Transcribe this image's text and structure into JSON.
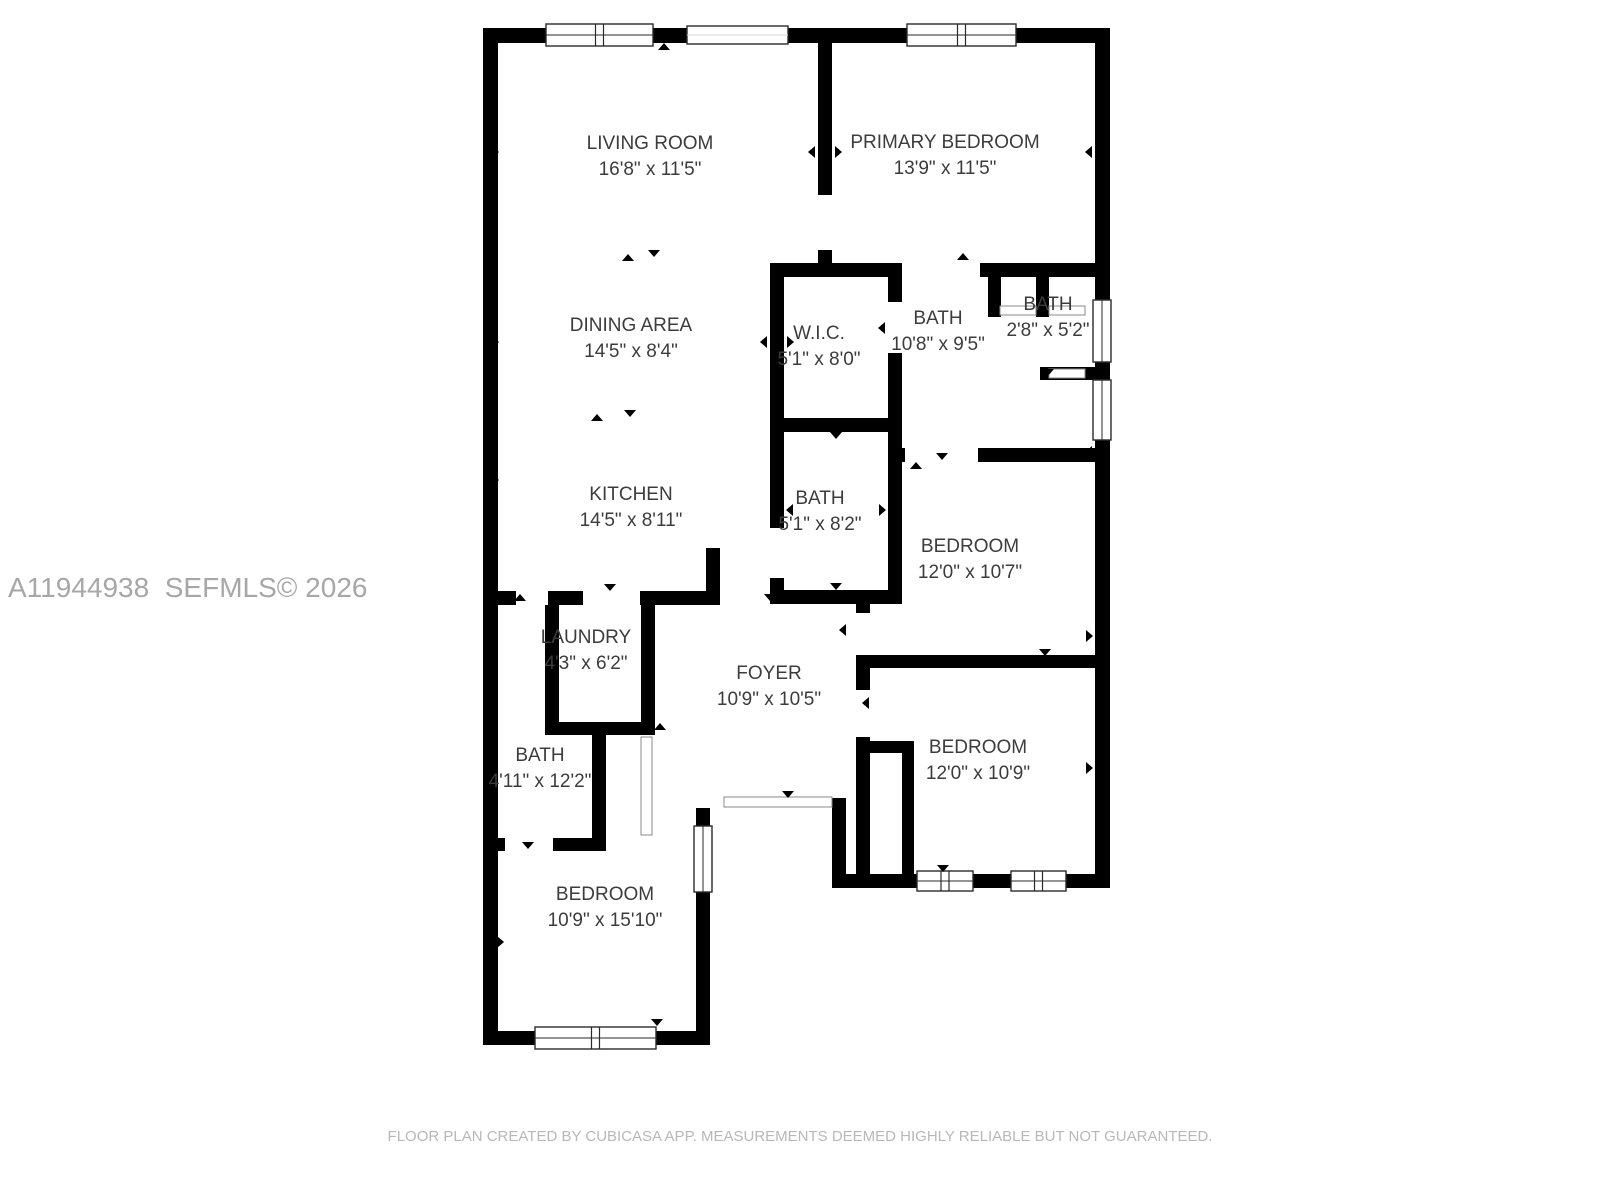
{
  "canvas": {
    "width": 1600,
    "height": 1200,
    "background": "#ffffff"
  },
  "watermark": {
    "text": "A11944938  SEFMLS© 2026",
    "x": 8,
    "y": 572,
    "color": "#a7a7a7",
    "size": 28
  },
  "footer": {
    "text": "FLOOR PLAN CREATED BY CUBICASA APP. MEASUREMENTS DEEMED HIGHLY RELIABLE BUT NOT GUARANTEED.",
    "y": 1128,
    "color": "#b9b7b7",
    "size": 15
  },
  "plan": {
    "wall_color": "#000000",
    "label_color": "#3c3c3c",
    "window_stroke": "#2a2a2a",
    "door_stroke": "#8a8a8a",
    "rooms": [
      {
        "name": "LIVING ROOM",
        "dim": "16'8\" x 11'5\"",
        "cx": 650,
        "y": 149
      },
      {
        "name": "PRIMARY BEDROOM",
        "dim": "13'9\" x 11'5\"",
        "cx": 945,
        "y": 148
      },
      {
        "name": "DINING AREA",
        "dim": "14'5\" x 8'4\"",
        "cx": 631,
        "y": 331
      },
      {
        "name": "W.I.C.",
        "dim": "5'1\" x 8'0\"",
        "cx": 819,
        "y": 339
      },
      {
        "name": "BATH",
        "dim": "10'8\" x 9'5\"",
        "cx": 938,
        "y": 324
      },
      {
        "name": "BATH",
        "dim": "2'8\" x 5'2\"",
        "cx": 1048,
        "y": 310
      },
      {
        "name": "KITCHEN",
        "dim": "14'5\" x 8'11\"",
        "cx": 631,
        "y": 500
      },
      {
        "name": "BATH",
        "dim": "5'1\" x 8'2\"",
        "cx": 820,
        "y": 504
      },
      {
        "name": "BEDROOM",
        "dim": "12'0\" x 10'7\"",
        "cx": 970,
        "y": 552
      },
      {
        "name": "LAUNDRY",
        "dim": "4'3\" x 6'2\"",
        "cx": 586,
        "y": 643
      },
      {
        "name": "FOYER",
        "dim": "10'9\" x 10'5\"",
        "cx": 769,
        "y": 679
      },
      {
        "name": "BATH",
        "dim": "4'11\" x 12'2\"",
        "cx": 540,
        "y": 761
      },
      {
        "name": "BEDROOM",
        "dim": "12'0\" x 10'9\"",
        "cx": 978,
        "y": 753
      },
      {
        "name": "BEDROOM",
        "dim": "10'9\" x 15'10\"",
        "cx": 605,
        "y": 900
      }
    ],
    "walls": [
      [
        483,
        28,
        627,
        15
      ],
      [
        483,
        28,
        15,
        1017
      ],
      [
        1095,
        28,
        15,
        860
      ],
      [
        832,
        874,
        278,
        14
      ],
      [
        483,
        1031,
        227,
        14
      ],
      [
        696,
        808,
        14,
        237
      ],
      [
        832,
        798,
        14,
        90
      ],
      [
        818,
        28,
        14,
        167
      ],
      [
        818,
        250,
        14,
        27
      ],
      [
        770,
        263,
        132,
        14
      ],
      [
        980,
        263,
        130,
        14
      ],
      [
        770,
        277,
        14,
        251
      ],
      [
        770,
        578,
        14,
        26
      ],
      [
        888,
        277,
        14,
        25
      ],
      [
        888,
        353,
        14,
        237
      ],
      [
        770,
        418,
        132,
        14
      ],
      [
        770,
        590,
        132,
        14
      ],
      [
        988,
        277,
        13,
        40
      ],
      [
        1036,
        277,
        13,
        40
      ],
      [
        1040,
        367,
        70,
        13
      ],
      [
        888,
        448,
        17,
        14
      ],
      [
        978,
        448,
        132,
        14
      ],
      [
        856,
        604,
        14,
        9
      ],
      [
        856,
        655,
        14,
        35
      ],
      [
        856,
        737,
        14,
        137
      ],
      [
        856,
        655,
        254,
        13
      ],
      [
        870,
        741,
        44,
        12
      ],
      [
        902,
        741,
        12,
        134
      ],
      [
        483,
        591,
        33,
        14
      ],
      [
        548,
        591,
        35,
        14
      ],
      [
        640,
        591,
        66,
        14
      ],
      [
        706,
        548,
        14,
        57
      ],
      [
        545,
        605,
        14,
        117
      ],
      [
        545,
        722,
        110,
        13
      ],
      [
        641,
        605,
        14,
        130
      ],
      [
        592,
        722,
        14,
        129
      ],
      [
        497,
        838,
        8,
        13
      ],
      [
        553,
        838,
        53,
        13
      ]
    ],
    "windows": [
      [
        546,
        24,
        107,
        22,
        "h2"
      ],
      [
        687,
        26,
        101,
        18,
        "h1"
      ],
      [
        907,
        24,
        109,
        22,
        "h2"
      ],
      [
        1093,
        300,
        18,
        62,
        "v1"
      ],
      [
        1093,
        380,
        18,
        60,
        "v1"
      ],
      [
        917,
        871,
        56,
        20,
        "h2"
      ],
      [
        1011,
        871,
        55,
        20,
        "h2"
      ],
      [
        694,
        826,
        18,
        66,
        "v1"
      ],
      [
        535,
        1027,
        121,
        22,
        "h2"
      ]
    ],
    "door_strips": [
      [
        724,
        797,
        108,
        10
      ],
      [
        1000,
        306,
        36,
        9
      ],
      [
        1049,
        306,
        36,
        9
      ],
      [
        1049,
        369,
        36,
        9
      ],
      [
        641,
        737,
        11,
        98
      ]
    ],
    "arrows": [
      [
        664,
        47,
        "up"
      ],
      [
        628,
        258,
        "up"
      ],
      [
        654,
        253,
        "down"
      ],
      [
        597,
        418,
        "up"
      ],
      [
        630,
        413,
        "down"
      ],
      [
        963,
        257,
        "up"
      ],
      [
        1022,
        269,
        "down"
      ],
      [
        942,
        456,
        "down"
      ],
      [
        916,
        466,
        "up"
      ],
      [
        1048,
        372,
        "down"
      ],
      [
        520,
        598,
        "up"
      ],
      [
        610,
        587,
        "down"
      ],
      [
        770,
        597,
        "down"
      ],
      [
        660,
        727,
        "up"
      ],
      [
        788,
        794,
        "down"
      ],
      [
        528,
        845,
        "down"
      ],
      [
        836,
        435,
        "down"
      ],
      [
        836,
        586,
        "down"
      ],
      [
        943,
        868,
        "down"
      ],
      [
        657,
        1022,
        "down"
      ],
      [
        1045,
        652,
        "down"
      ],
      [
        875,
        662,
        "up"
      ],
      [
        495,
        152,
        "right"
      ],
      [
        812,
        152,
        "left"
      ],
      [
        838,
        152,
        "right"
      ],
      [
        1089,
        152,
        "left"
      ],
      [
        495,
        342,
        "right"
      ],
      [
        764,
        342,
        "left"
      ],
      [
        790,
        342,
        "right"
      ],
      [
        882,
        328,
        "left"
      ],
      [
        495,
        480,
        "right"
      ],
      [
        1089,
        452,
        "left"
      ],
      [
        790,
        510,
        "left"
      ],
      [
        882,
        510,
        "right"
      ],
      [
        843,
        630,
        "left"
      ],
      [
        866,
        703,
        "left"
      ],
      [
        1089,
        636,
        "right"
      ],
      [
        1089,
        768,
        "right"
      ],
      [
        500,
        942,
        "right"
      ],
      [
        706,
        942,
        "left"
      ]
    ]
  }
}
